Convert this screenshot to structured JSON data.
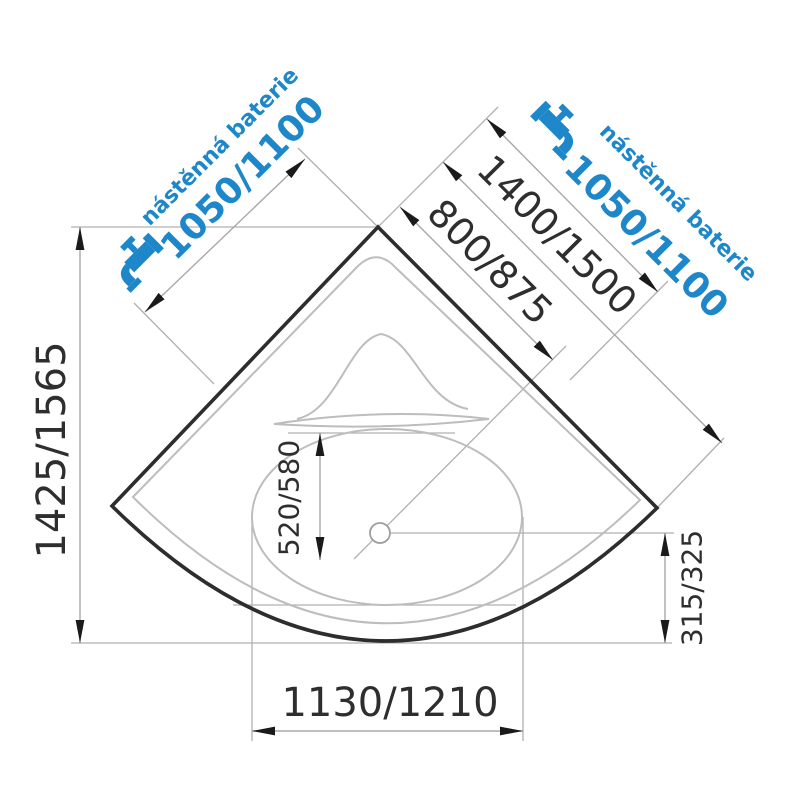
{
  "image": {
    "alt": "Corner bathtub plan view with dimension lines"
  },
  "colors": {
    "accent_blue": "#1d87c9",
    "line_dark": "#2d2d2d",
    "dim_gray": "#a8a8a8",
    "inner_gray": "#bdbdbd",
    "text_dark": "#2e2e2e"
  },
  "dimensions": {
    "overall_depth": "1425/1565",
    "front_width": "1130/1210",
    "basin_depth": "520/580",
    "drain_to_front": "315/325",
    "corner_to_drain": "800/875",
    "wall_length": "1400/1500"
  },
  "faucet_left": {
    "caption": "nástěnná baterie",
    "value": "1050/1100"
  },
  "faucet_right": {
    "caption": "nástěnná baterie",
    "value": "1050/1100"
  }
}
